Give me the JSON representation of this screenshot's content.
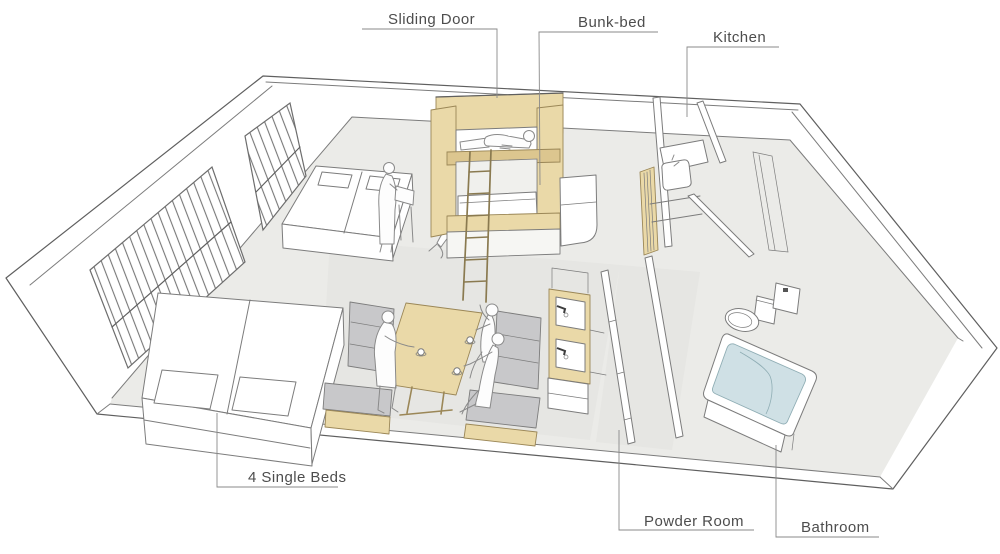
{
  "diagram": {
    "type": "axonometric-floor-plan-sketch",
    "labels": {
      "sliding_door": "Sliding Door",
      "bunk_bed": "Bunk-bed",
      "kitchen": "Kitchen",
      "single_beds": "4 Single Beds",
      "powder_room": "Powder Room",
      "bathroom": "Bathroom"
    },
    "colors": {
      "wood": "#ead9a8",
      "wood_shade": "#dcc68f",
      "wood_edge": "#9b8757",
      "sofa": "#c8c8ca",
      "water": "#cfe0e5",
      "water_edge": "#8fadb4",
      "floor": "#ebebe8",
      "wash": "#e2e2df",
      "line": "#7c7c7c",
      "line_dark": "#5f5f5f",
      "label": "#4d4d4d"
    }
  }
}
